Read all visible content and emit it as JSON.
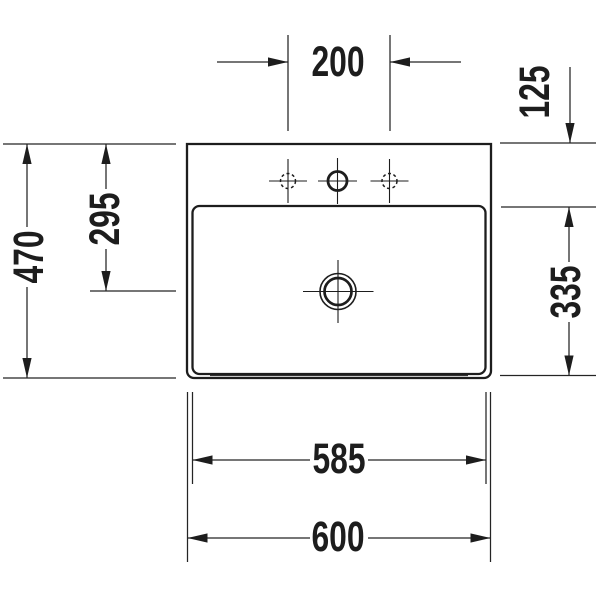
{
  "diagram": {
    "kind": "technical-dimension-drawing",
    "subject": "washbasin-top-view",
    "line_color": "#1d1d1d",
    "background": "#ffffff",
    "dimensions": {
      "d200": "200",
      "d125": "125",
      "d470": "470",
      "d295": "295",
      "d335": "335",
      "d585": "585",
      "d600": "600"
    }
  }
}
